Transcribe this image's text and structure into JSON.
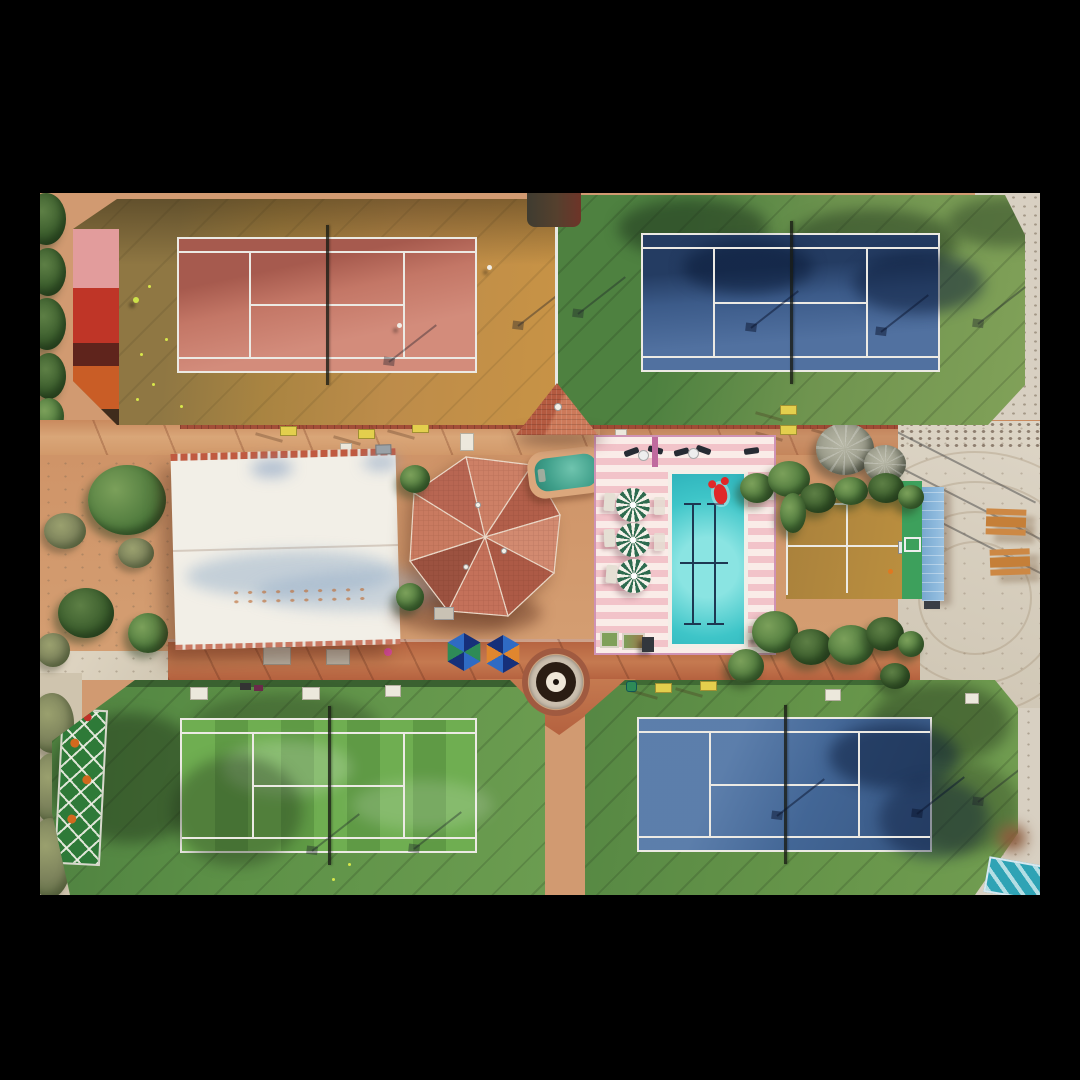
{
  "scene": {
    "description": "Aerial top-down drone photograph of a colorful tennis club: four fenced tennis courts around a central clubhouse, tiled pavilion, spa and a swimming pool with pink striped deck",
    "view": "top-down aerial, photo letterboxed on black",
    "courts": [
      {
        "id": "top-left",
        "surface": "clay red",
        "surface_color": "#cf8270",
        "surround_color": "#b08445",
        "players_visible": 3
      },
      {
        "id": "top-right",
        "surface": "hard blue",
        "surface_color": "#46689a",
        "surround_color": "#6f944f",
        "players_visible": 0
      },
      {
        "id": "bottom-left",
        "surface": "striped green",
        "surface_color": "#68a54c",
        "surround_color": "#5d9147",
        "players_visible": 0
      },
      {
        "id": "bottom-right",
        "surface": "hard blue",
        "surface_color": "#4a70a2",
        "surround_color": "#659449",
        "players_visible": 0
      }
    ],
    "pool": {
      "water_color": "#3ec5c8",
      "deck": "pink and white horizontal stripes",
      "float": "red lobster inflatable",
      "pinwheel_umbrellas": 3,
      "loungers": "dark loungers at top, white loungers by umbrellas"
    },
    "spa": {
      "shape": "kidney",
      "water_color": "#3f9f8a"
    },
    "buildings": [
      {
        "id": "clubhouse",
        "roof": "white with red tile ridges and faded blue band"
      },
      {
        "id": "pavilion",
        "roof": "octagonal terracotta tile hip roof"
      },
      {
        "id": "gazebo",
        "roof": "triangular terracotta tile roof"
      },
      {
        "id": "practice-wall",
        "roof": "light blue tarp beside green wall"
      }
    ],
    "furniture": {
      "yellow_benches": 7,
      "white_benches": 6,
      "picnic_tables": 2,
      "hex_umbrellas": 2
    },
    "fountain": {
      "style": "concentric dark and cream rings on circular plaza"
    },
    "misc": [
      "sand and scrub on left and right margins",
      "power line shadows over sand",
      "green diamond-pattern mat lower left",
      "teal structure bottom right",
      "red and orange windscreens on top-left court"
    ]
  },
  "palette": {
    "background": "#000000",
    "sand": "#d5c9b4",
    "sand_light": "#e0d8c8",
    "pavement": "#d19a71",
    "pavement_light": "#dcab80",
    "pavement_red": "#b4613f",
    "brick": "#a34e38",
    "ochre": "#bd8c4a",
    "ochre_brown": "#8f7743",
    "clay": "#cf8270",
    "clay_dark": "#a85b51",
    "green_surround": "#6f944f",
    "green_surround_dark": "#4e8140",
    "green_dark": "#3a6130",
    "blue_court": "#46689a",
    "blue_court2": "#4a70a2",
    "blue_shadow": "#1d3454",
    "green_court_a": "#6fae51",
    "green_court_b": "#5f9a45",
    "line": "#eceae4",
    "roof_white": "#f2efe7",
    "ridge_red": "#c05a40",
    "terracotta": "#c4715a",
    "spa_water": "#3f9f8a",
    "pool_water": "#3ec5c8",
    "pool_water_light": "#8ae4e2",
    "deck_pink": "#f2c3c9",
    "deck_white": "#faece8",
    "deck_fence": "#cf93b5",
    "umbrella_green": "#2e6b4f",
    "hex_blue": "#2f6bc4",
    "hex_navy": "#16307a",
    "hex_green": "#2e8b57",
    "hex_orange": "#e0862e",
    "lobster": "#e02828",
    "bench_yellow": "#e3cf4d",
    "table_orange": "#cd8844",
    "tarp_blue": "#8cb8dc",
    "wall_green": "#3da05c",
    "mat_green": "#2e7a38",
    "teal_object": "#2fa3b5",
    "windscreen_pink": "#e29c9c",
    "windscreen_red": "#bf3527",
    "windscreen_maroon": "#5f241c",
    "windscreen_orange": "#c95d26"
  }
}
